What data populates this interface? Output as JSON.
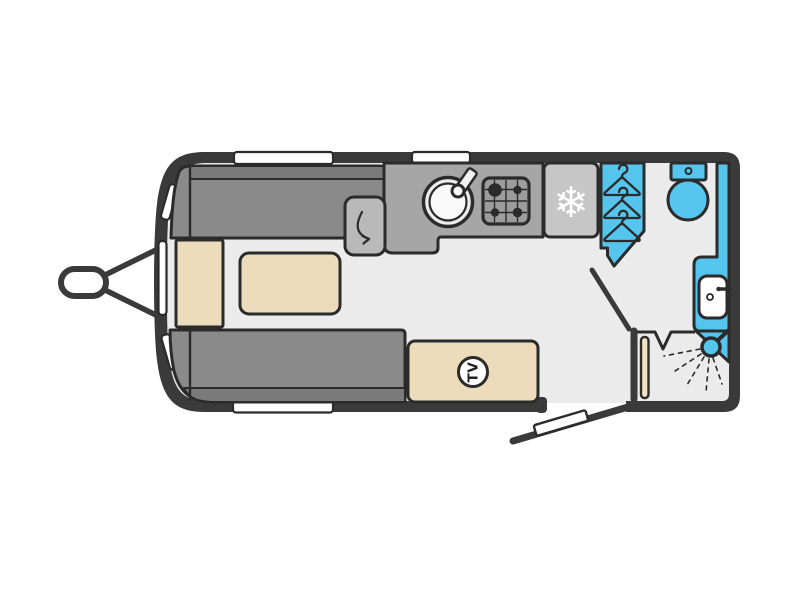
{
  "title": "Caravan floorplan diagram",
  "floorplan": {
    "type": "touring-caravan-top-view",
    "orientation": "hitch-left",
    "labels": {
      "tv": "TV"
    },
    "icons": {
      "snowflake": "❄",
      "hanger_count": "3",
      "shower": "shower-head-with-spray",
      "swivel_arrow": "worktop-fold-out-arrow",
      "sink": "round-sink-with-tap",
      "hob": "four-burner-grid"
    },
    "zones": {
      "lounge": [
        "offside-sofa",
        "nearside-sofa",
        "front-chest",
        "table"
      ],
      "kitchen": [
        "worktop-flap",
        "sink",
        "hob",
        "fridge"
      ],
      "washroom": [
        "wardrobe",
        "toilet",
        "washbasin-vanity",
        "corner-shower",
        "corner-shelf"
      ],
      "entrance": [
        "entry-door-open",
        "washroom-door"
      ]
    },
    "window_count": 6,
    "colors": {
      "wall": "#3a3a3a",
      "outline": "#2b2b2b",
      "floor": "#ebebeb",
      "sofa": "#8a8a8a",
      "sofa_backrest": "#7a7a7a",
      "upholstery_cream": "#eddcbb",
      "worktop": "#a6a6a6",
      "worktop_flap": "#b9b9b9",
      "fridge": "#c6c6c6",
      "accent_blue": "#55c5ee",
      "window": "#ffffff",
      "background": "#ffffff"
    }
  }
}
